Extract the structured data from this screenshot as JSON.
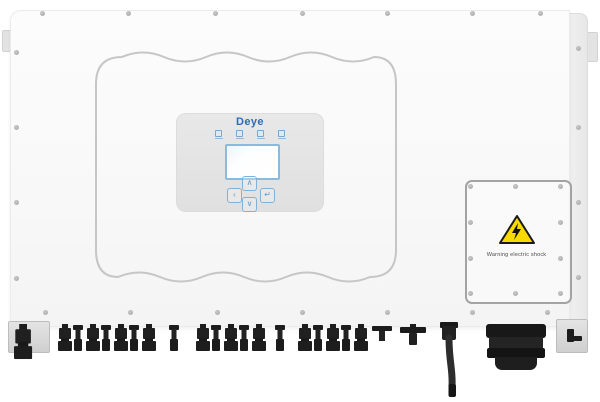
{
  "device": {
    "brand": "Deye",
    "type_label": "solar string inverter front view"
  },
  "display": {
    "logo": "Deye",
    "led_count": 4,
    "screen_content": "",
    "buttons": [
      {
        "name": "up",
        "glyph": "∧"
      },
      {
        "name": "left",
        "glyph": "‹"
      },
      {
        "name": "enter",
        "glyph": "↵"
      },
      {
        "name": "down",
        "glyph": "∨"
      }
    ]
  },
  "access_panel": {
    "warning_text": "Warning electric shock",
    "screws": [
      [
        470,
        186
      ],
      [
        515,
        186
      ],
      [
        560,
        186
      ],
      [
        470,
        222
      ],
      [
        560,
        222
      ],
      [
        470,
        258
      ],
      [
        560,
        258
      ],
      [
        470,
        293
      ],
      [
        515,
        293
      ],
      [
        560,
        293
      ]
    ]
  },
  "chassis_screws": [
    [
      42,
      13
    ],
    [
      128,
      13
    ],
    [
      215,
      13
    ],
    [
      302,
      13
    ],
    [
      387,
      13
    ],
    [
      472,
      13
    ],
    [
      540,
      13
    ],
    [
      45,
      312
    ],
    [
      130,
      312
    ],
    [
      217,
      312
    ],
    [
      302,
      312
    ],
    [
      387,
      312
    ],
    [
      472,
      312
    ],
    [
      547,
      312
    ],
    [
      16,
      52
    ],
    [
      16,
      127
    ],
    [
      16,
      202
    ],
    [
      16,
      278
    ],
    [
      578,
      48
    ],
    [
      578,
      127
    ],
    [
      578,
      202
    ],
    [
      578,
      277
    ]
  ],
  "connectors": [
    {
      "x": 14,
      "type": "plug",
      "scale": 1.3
    },
    {
      "x": 58,
      "type": "plug"
    },
    {
      "x": 72,
      "type": "nut"
    },
    {
      "x": 86,
      "type": "plug"
    },
    {
      "x": 100,
      "type": "nut"
    },
    {
      "x": 114,
      "type": "plug"
    },
    {
      "x": 128,
      "type": "nut"
    },
    {
      "x": 142,
      "type": "plug"
    },
    {
      "x": 168,
      "type": "nut"
    },
    {
      "x": 196,
      "type": "plug"
    },
    {
      "x": 210,
      "type": "nut"
    },
    {
      "x": 224,
      "type": "plug"
    },
    {
      "x": 238,
      "type": "nut"
    },
    {
      "x": 252,
      "type": "plug"
    },
    {
      "x": 274,
      "type": "nut"
    },
    {
      "x": 298,
      "type": "plug"
    },
    {
      "x": 312,
      "type": "nut"
    },
    {
      "x": 326,
      "type": "plug"
    },
    {
      "x": 340,
      "type": "nut"
    },
    {
      "x": 354,
      "type": "plug"
    },
    {
      "x": 372,
      "type": "comm_small"
    },
    {
      "x": 400,
      "type": "comm"
    }
  ],
  "colors": {
    "brand_blue": "#2e6cb5",
    "lcd_border_blue": "#8abbdd",
    "button_blue": "#5b9ed2",
    "warning_yellow": "#f8d900",
    "connector_black": "#1d1d1d",
    "panel_grey": "#e4e4e4",
    "emboss_line_grey": "#c6c6c6",
    "body_white": "#fafafa"
  }
}
